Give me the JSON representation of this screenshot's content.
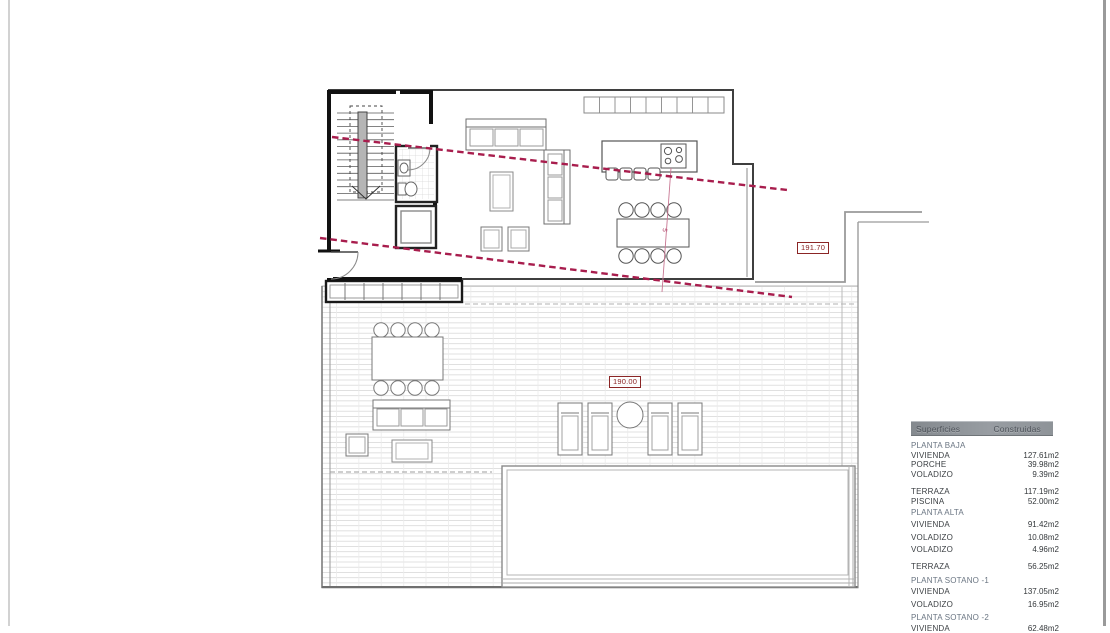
{
  "plan": {
    "levels": [
      {
        "name": "upper-floor-level",
        "value": "191.70"
      },
      {
        "name": "terrace-level",
        "value": "190.00"
      }
    ],
    "section_mark": "5",
    "colors": {
      "section_line": "#a81d4d",
      "level_label": "#8b2525",
      "wall": "#1a1a1a",
      "furniture_line": "#6e6e6e",
      "deck_line": "#dadada"
    }
  },
  "areas_table": {
    "header": {
      "col_label": "Superficies",
      "col_value": "Construidas"
    },
    "rows": [
      {
        "label": "PLANTA BAJA",
        "value": "",
        "type": "section"
      },
      {
        "label": "VIVIENDA",
        "value": "127.61m2"
      },
      {
        "label": "PORCHE",
        "value": "39.98m2"
      },
      {
        "label": "VOLADIZO",
        "value": "9.39m2"
      },
      {
        "label": "TERRAZA",
        "value": "117.19m2"
      },
      {
        "label": "PISCINA",
        "value": "52.00m2"
      },
      {
        "label": "PLANTA ALTA",
        "value": "",
        "type": "section"
      },
      {
        "label": "VIVIENDA",
        "value": "91.42m2"
      },
      {
        "label": "VOLADIZO",
        "value": "10.08m2"
      },
      {
        "label": "VOLADIZO",
        "value": "4.96m2"
      },
      {
        "label": "TERRAZA",
        "value": "56.25m2"
      },
      {
        "label": "PLANTA SOTANO -1",
        "value": "",
        "type": "section"
      },
      {
        "label": "VIVIENDA",
        "value": "137.05m2"
      },
      {
        "label": "VOLADIZO",
        "value": "16.95m2"
      },
      {
        "label": "PLANTA SOTANO -2",
        "value": "",
        "type": "section"
      },
      {
        "label": "VIVIENDA",
        "value": "62.48m2"
      }
    ]
  }
}
